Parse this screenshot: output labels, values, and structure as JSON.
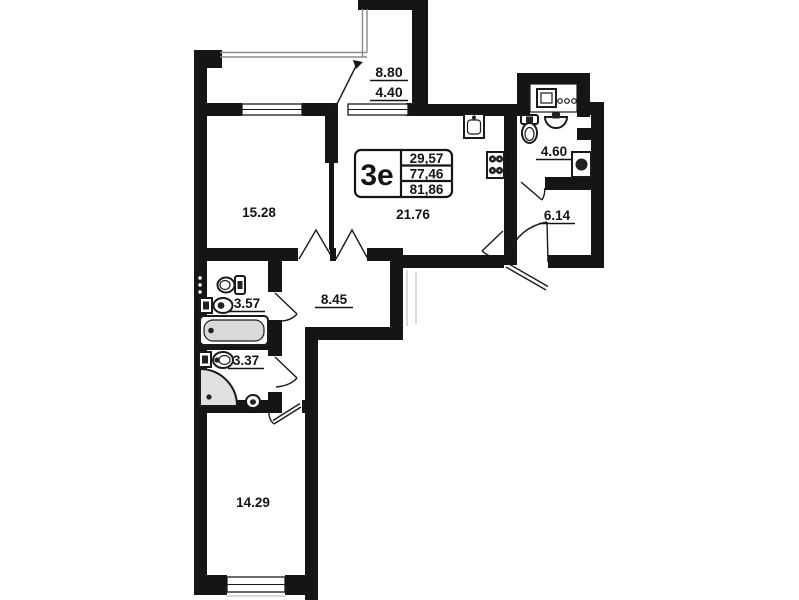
{
  "plan": {
    "title": "Apartment floor plan",
    "stamp": {
      "unit_label": "3е",
      "living_area": "29,57",
      "area_without_balcony": "77,46",
      "total_area": "81,86"
    },
    "rooms": {
      "bedroom_top": {
        "area": "15.28"
      },
      "kitchen_living": {
        "area": "21.76"
      },
      "hallway": {
        "area": "8.45"
      },
      "bathroom_large": {
        "area": "3.57"
      },
      "bathroom_small": {
        "area": "3.37"
      },
      "bedroom_bottom": {
        "area": "14.29"
      },
      "bathroom_entrance": {
        "area": "4.60"
      },
      "entry_hall": {
        "area": "6.14"
      },
      "balcony": {
        "area_full": "8.80",
        "area_counted": "4.40"
      }
    },
    "icons": {
      "bathtub": "bathtub-icon",
      "corner_shower": "corner-shower-icon",
      "toilet": "toilet-icon",
      "sink": "sink-icon",
      "kitchen_sink": "kitchen-sink-icon",
      "stove": "stove-4-burner-icon",
      "counter_sink": "counter-sink-icon",
      "washing_machine": "washing-machine-icon",
      "towel_radiator": "towel-radiator-icon",
      "entrance_door": "entrance-door-icon"
    },
    "colors": {
      "wall": "#151515",
      "bathtub_fill": "#d9d9d9",
      "shower_fill": "#e0e0e0",
      "glazing": "#8a8a8a"
    }
  }
}
